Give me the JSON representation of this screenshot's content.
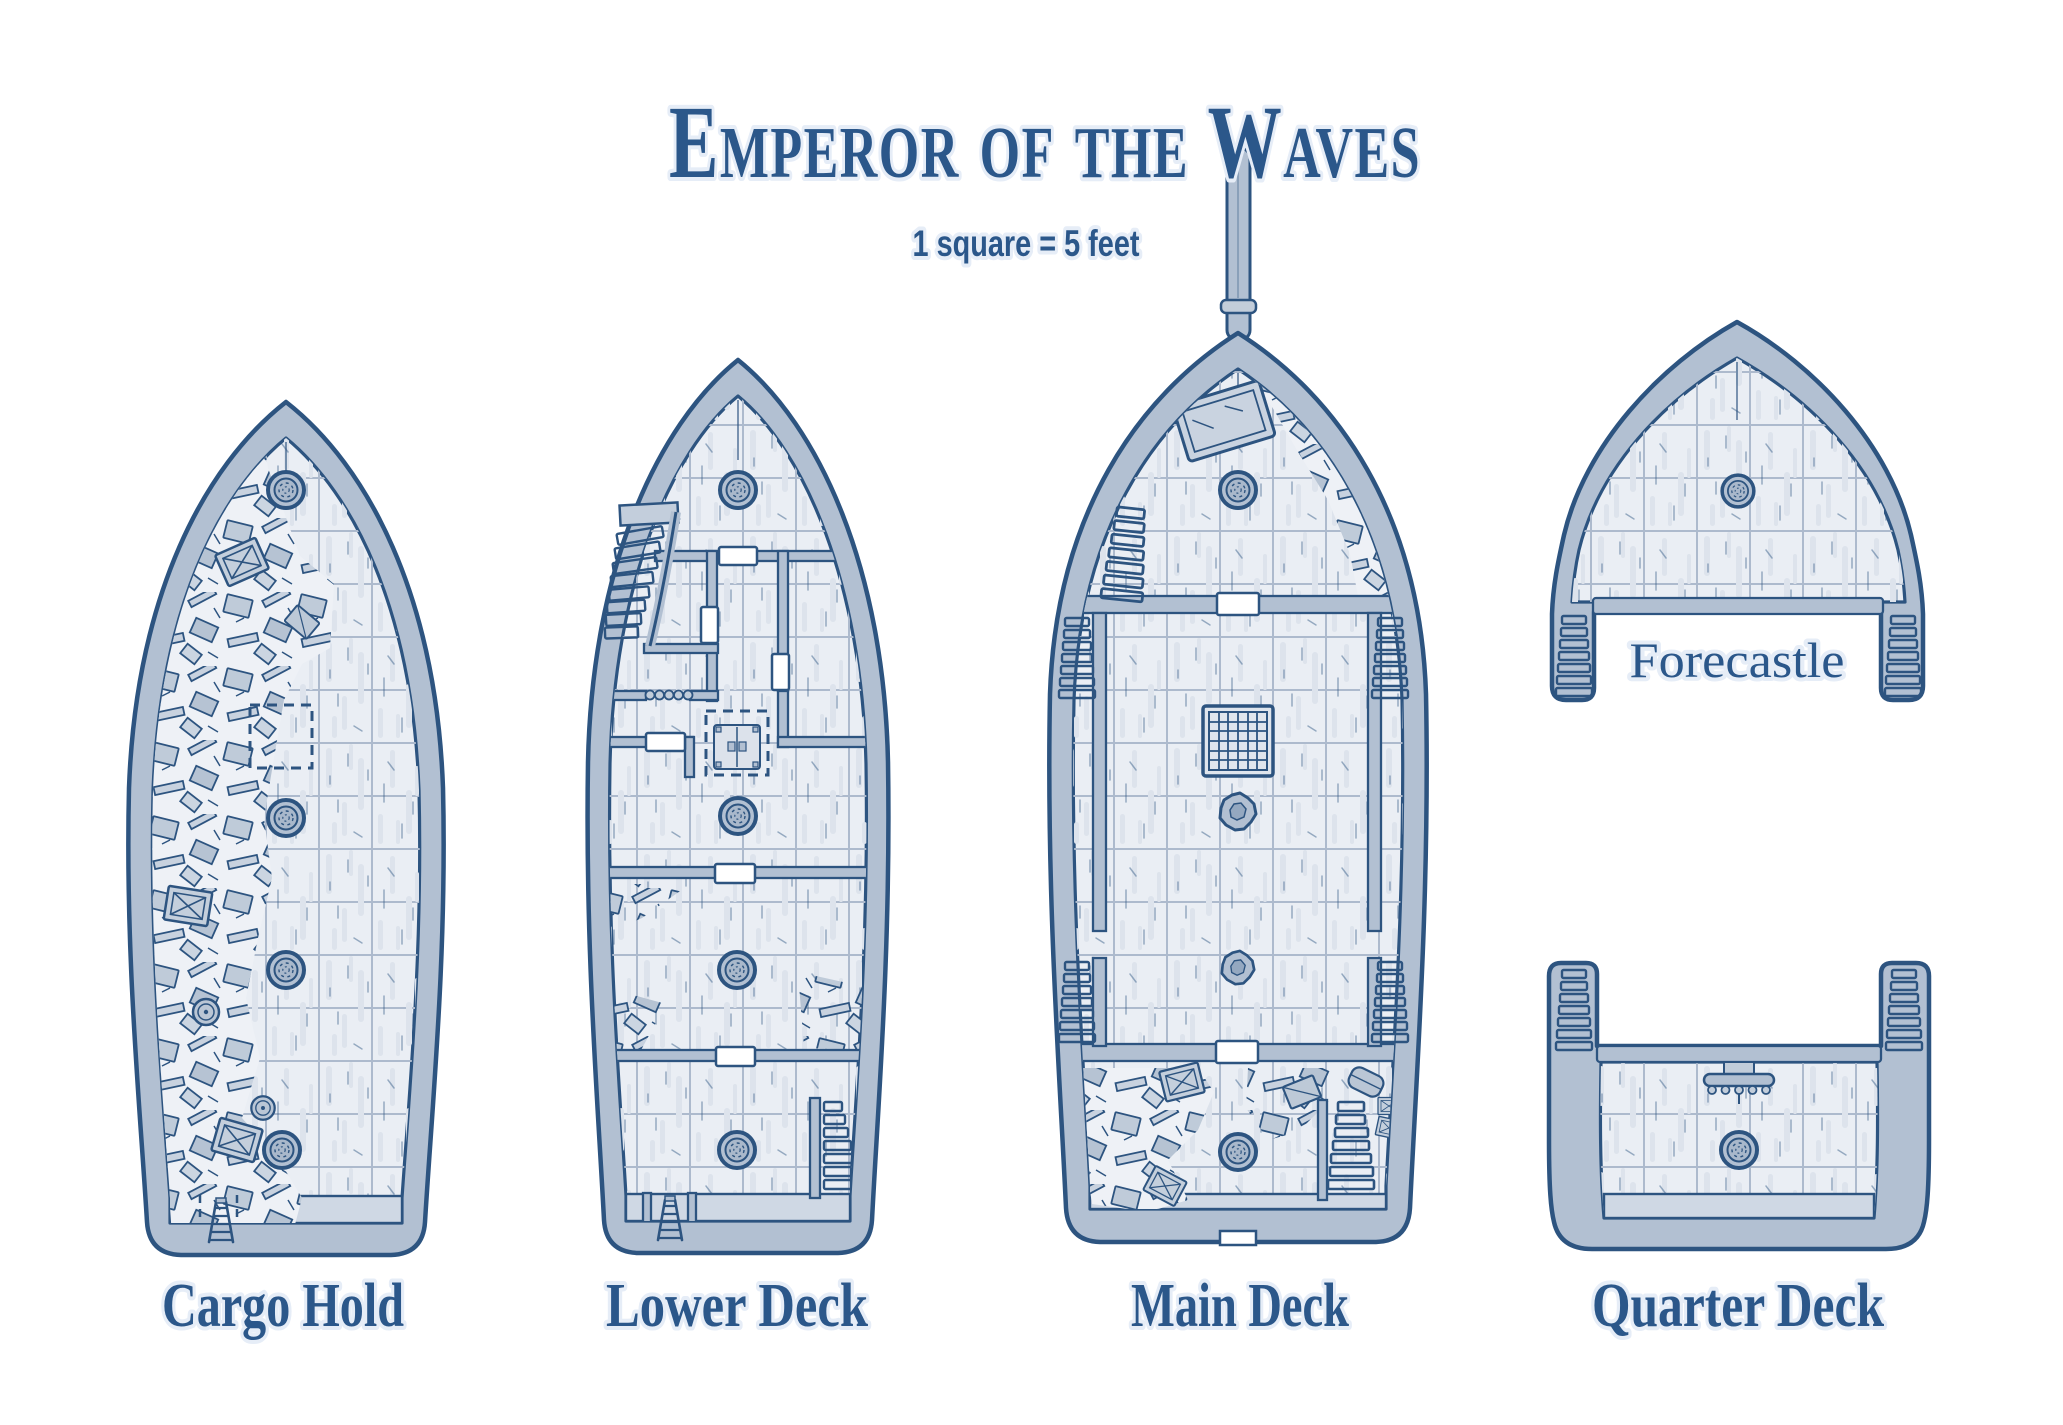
{
  "title": "Emperor of the Waves",
  "scale_note": "1 square = 5 feet",
  "decks": [
    {
      "id": "cargo-hold",
      "label": "Cargo Hold"
    },
    {
      "id": "lower-deck",
      "label": "Lower Deck"
    },
    {
      "id": "main-deck",
      "label": "Main Deck"
    },
    {
      "id": "quarter-deck",
      "label": "Quarter Deck"
    },
    {
      "id": "forecastle",
      "label": "Forecastle"
    }
  ],
  "colors": {
    "ink": "#2d5480",
    "text": "#2b578a",
    "hull_band": "#b2c0d2",
    "deck_fill": "#eaeef4",
    "grid_line": "#adbacd",
    "plank_streak": "#dde3ec",
    "paper": "#ffffff",
    "debris_bg": "#eef1f6"
  }
}
